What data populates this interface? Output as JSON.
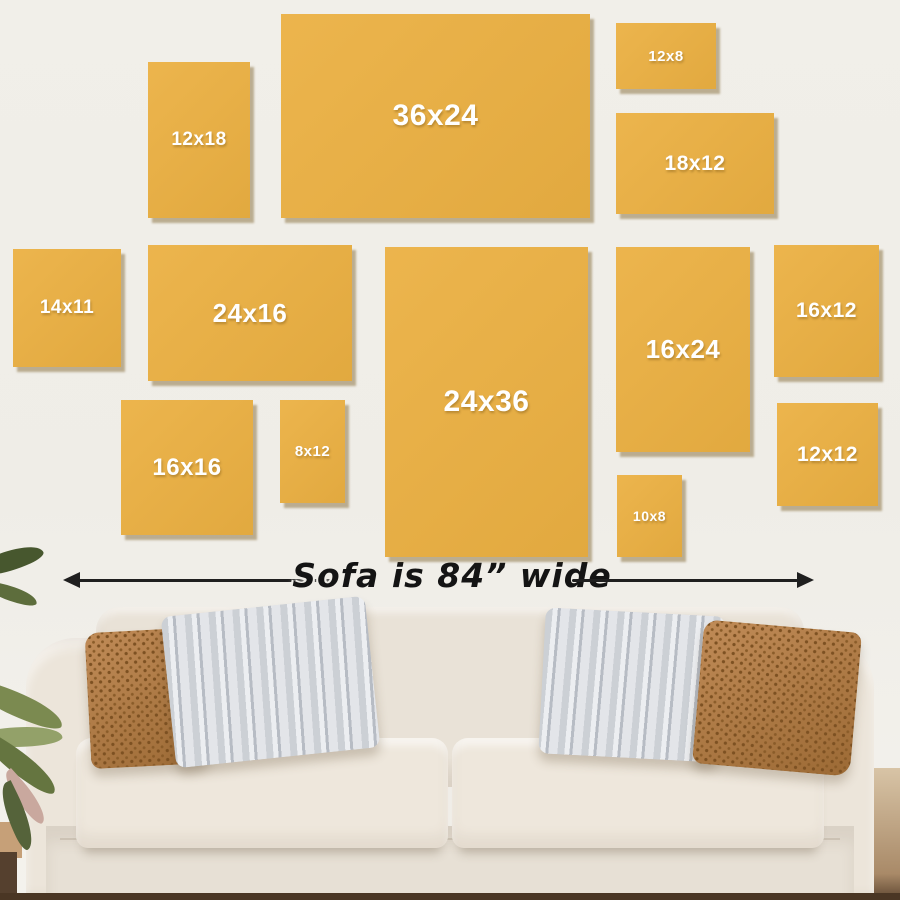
{
  "scene": {
    "caption": "Sofa is 84” wide"
  },
  "frames": [
    {
      "id": "12x18",
      "label": "12x18"
    },
    {
      "id": "36x24",
      "label": "36x24"
    },
    {
      "id": "12x8",
      "label": "12x8"
    },
    {
      "id": "18x12",
      "label": "18x12"
    },
    {
      "id": "14x11",
      "label": "14x11"
    },
    {
      "id": "24x16",
      "label": "24x16"
    },
    {
      "id": "24x36",
      "label": "24x36"
    },
    {
      "id": "16x24",
      "label": "16x24"
    },
    {
      "id": "16x12",
      "label": "16x12"
    },
    {
      "id": "16x16",
      "label": "16x16"
    },
    {
      "id": "8x12",
      "label": "8x12"
    },
    {
      "id": "10x8",
      "label": "10x8"
    },
    {
      "id": "12x12",
      "label": "12x12"
    }
  ],
  "colors": {
    "frame": "#ebb042",
    "frame_label": "#ffffff",
    "wall": "#f0eee8",
    "arrow": "#1f1f1f",
    "sofa": "#e9e2d7",
    "pillow_brown": "#ab783f",
    "pillow_gray": "#ccd0d5"
  }
}
